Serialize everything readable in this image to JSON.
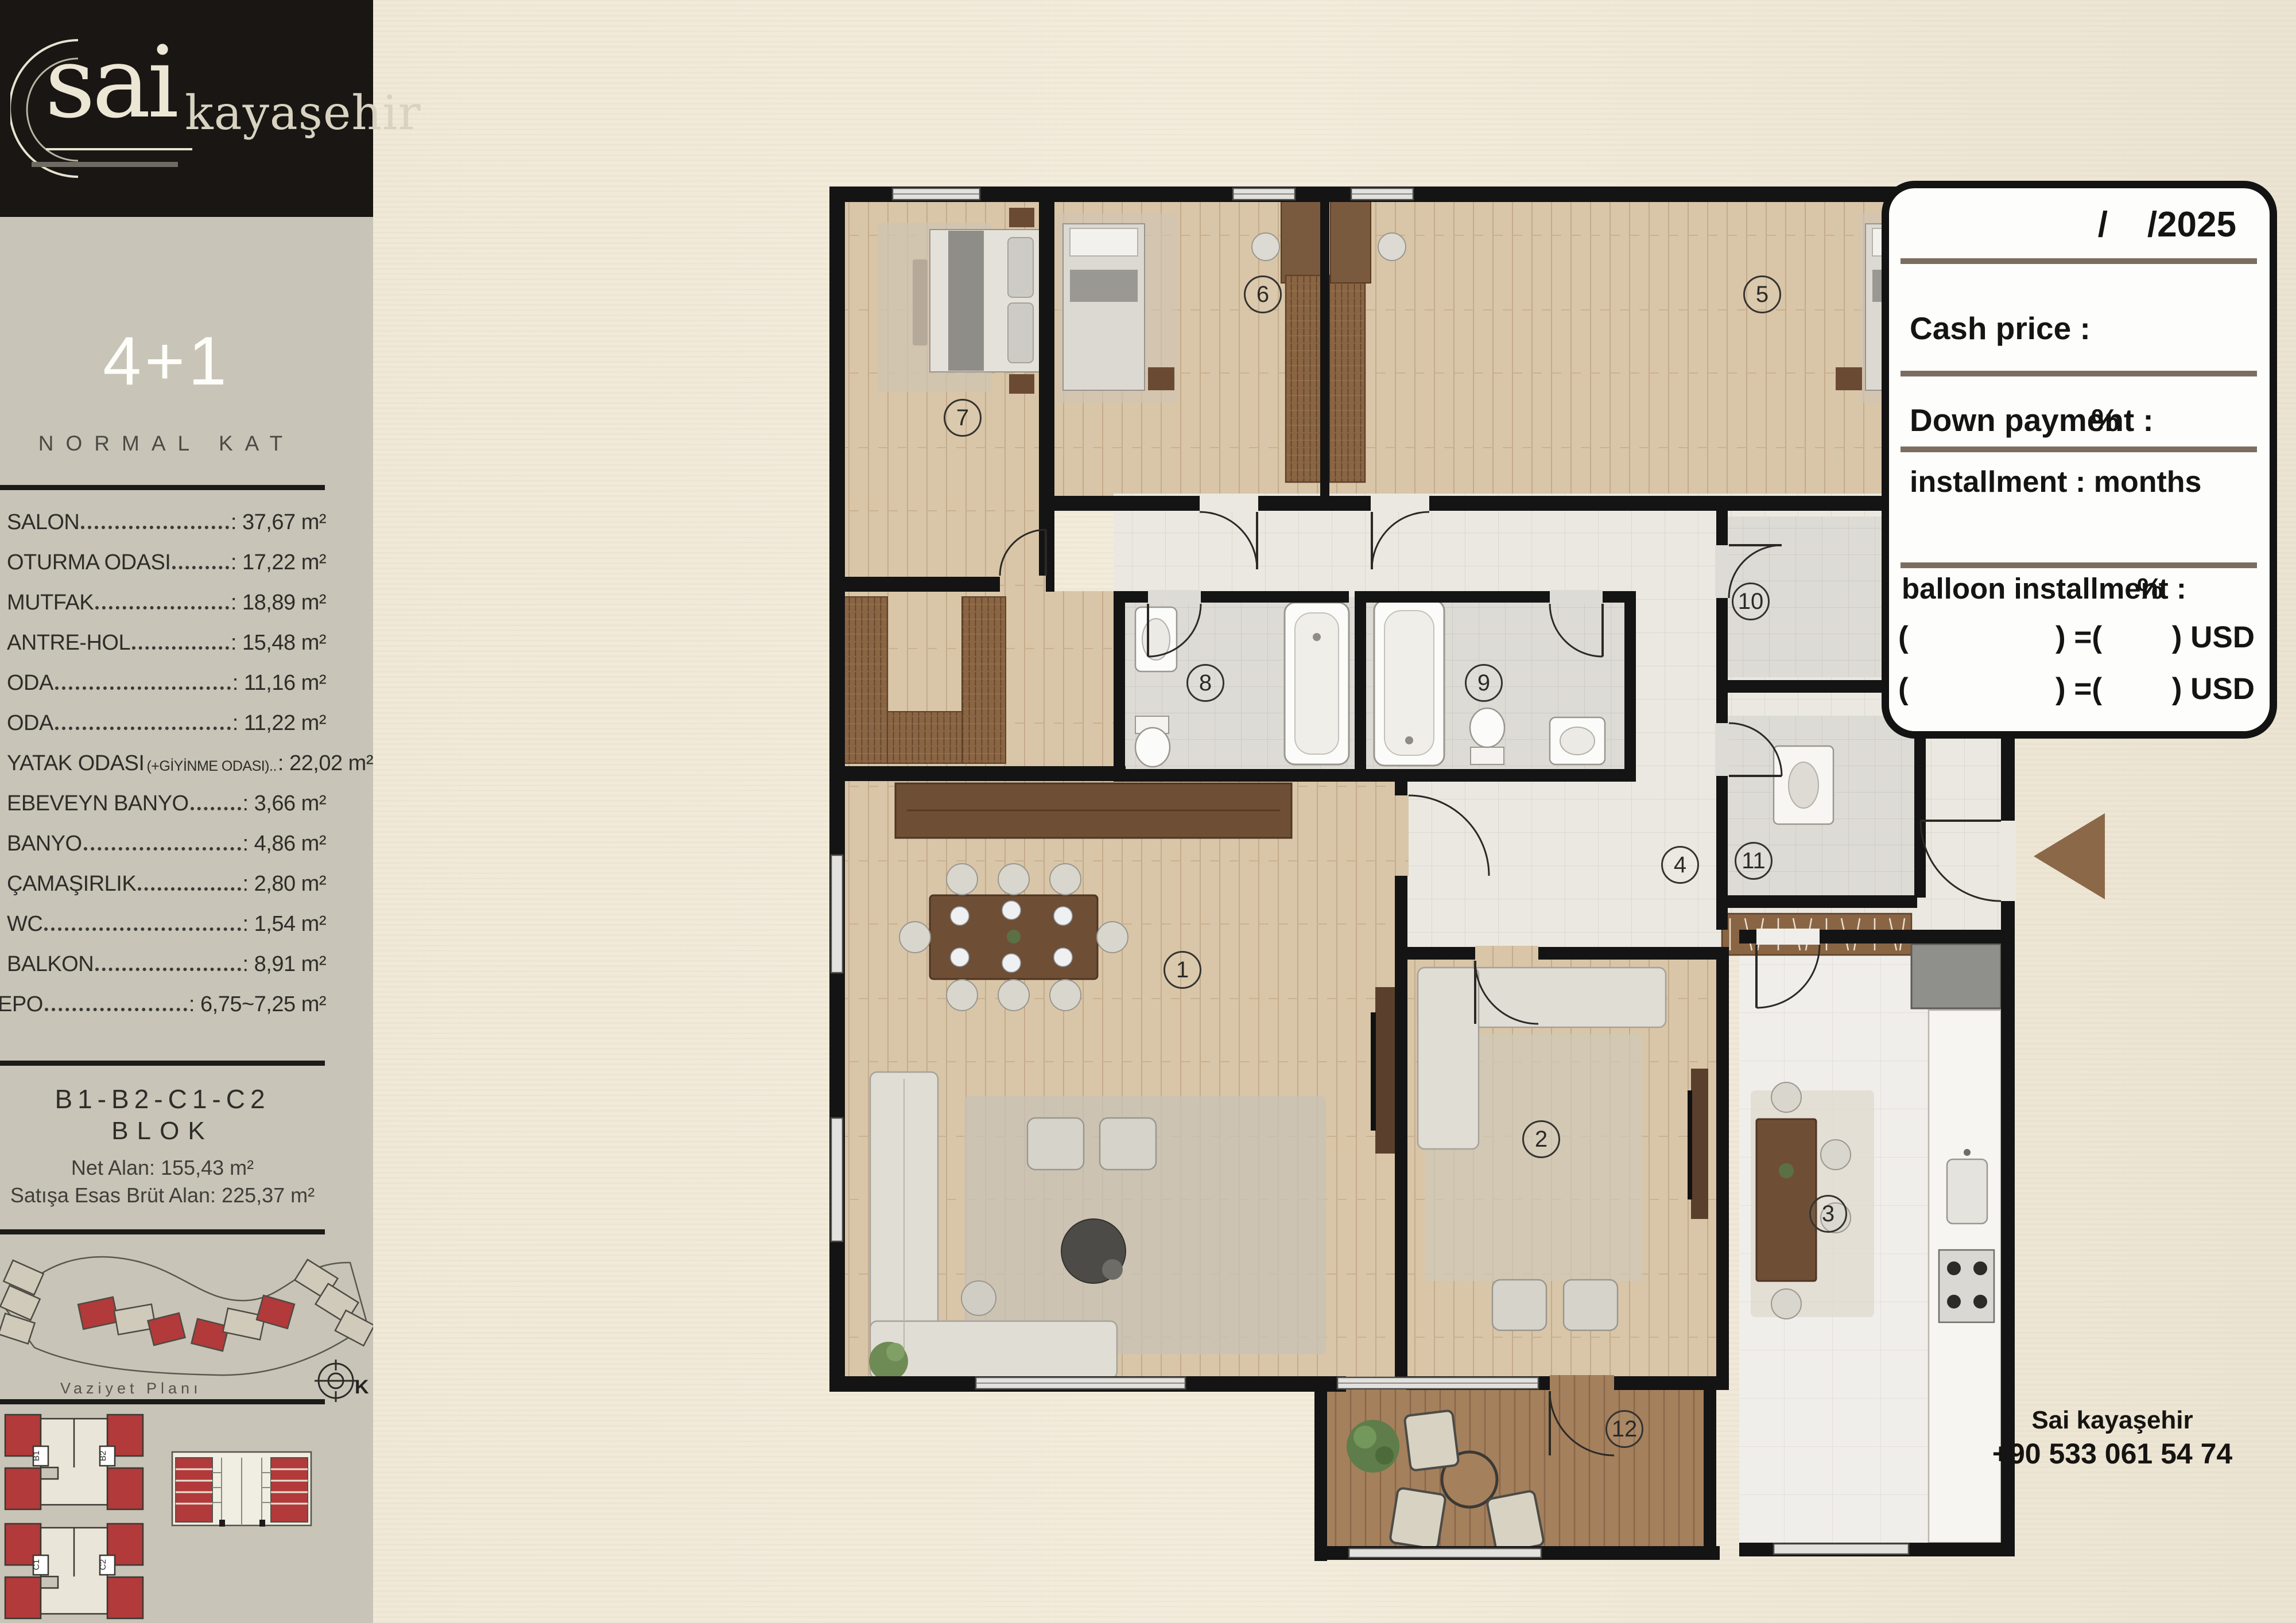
{
  "brand": {
    "logo_main": "sai",
    "logo_sub": "kayaşehir"
  },
  "sidebar": {
    "unit_type": "4+1",
    "floor_label": "NORMAL KAT",
    "rooms": [
      {
        "label": "SALON",
        "value": ": 37,67 m²"
      },
      {
        "label": "OTURMA ODASI",
        "value": ": 17,22 m²"
      },
      {
        "label": "MUTFAK",
        "value": ": 18,89 m²"
      },
      {
        "label": "ANTRE-HOL",
        "value": ": 15,48 m²"
      },
      {
        "label": "ODA",
        "value": ": 11,16 m²"
      },
      {
        "label": "ODA",
        "value": ": 11,22 m²"
      },
      {
        "label": "YATAK ODASI",
        "sublabel": "(+GİYİNME ODASI)..",
        "value": ": 22,02 m²"
      },
      {
        "label": "EBEVEYN BANYO",
        "value": ": 3,66 m²"
      },
      {
        "label": "BANYO",
        "value": ": 4,86 m²"
      },
      {
        "label": "ÇAMAŞIRLIK",
        "value": ": 2,80 m²"
      },
      {
        "label": "WC",
        "value": ": 1,54 m²"
      },
      {
        "label": "BALKON",
        "value": ": 8,91 m²"
      },
      {
        "label": "EPO",
        "value": ": 6,75~7,25 m²"
      }
    ],
    "block": {
      "line1": "B1-B2-C1-C2",
      "line2": "BLOK",
      "net": "Net Alan: 155,43 m²",
      "gross": "Satışa Esas Brüt Alan: 225,37 m²"
    },
    "siteplan_label": "Vaziyet Planı",
    "compass_label": "K",
    "plate1": {
      "a": "B1",
      "b": "B2"
    },
    "plate2": {
      "a": "C1",
      "b": "C2"
    }
  },
  "plan": {
    "room_numbers": [
      "1",
      "2",
      "3",
      "4",
      "5",
      "6",
      "7",
      "8",
      "9",
      "10",
      "11",
      "12"
    ]
  },
  "pricing": {
    "date": "/    /2025",
    "cash_label": "Cash price :",
    "down_label": "Down payment :",
    "down_unit": "%",
    "installment_label": "installment : months",
    "balloon_label": "balloon installment :",
    "balloon_unit": "%",
    "usd_rows": [
      {
        "open": "(",
        "mid": ") =(",
        "end": ") USD"
      },
      {
        "open": "(",
        "mid": ") =(",
        "end": ") USD"
      }
    ]
  },
  "contact": {
    "name": "Sai kayaşehir",
    "phone": "+90 533 061 54 74"
  }
}
